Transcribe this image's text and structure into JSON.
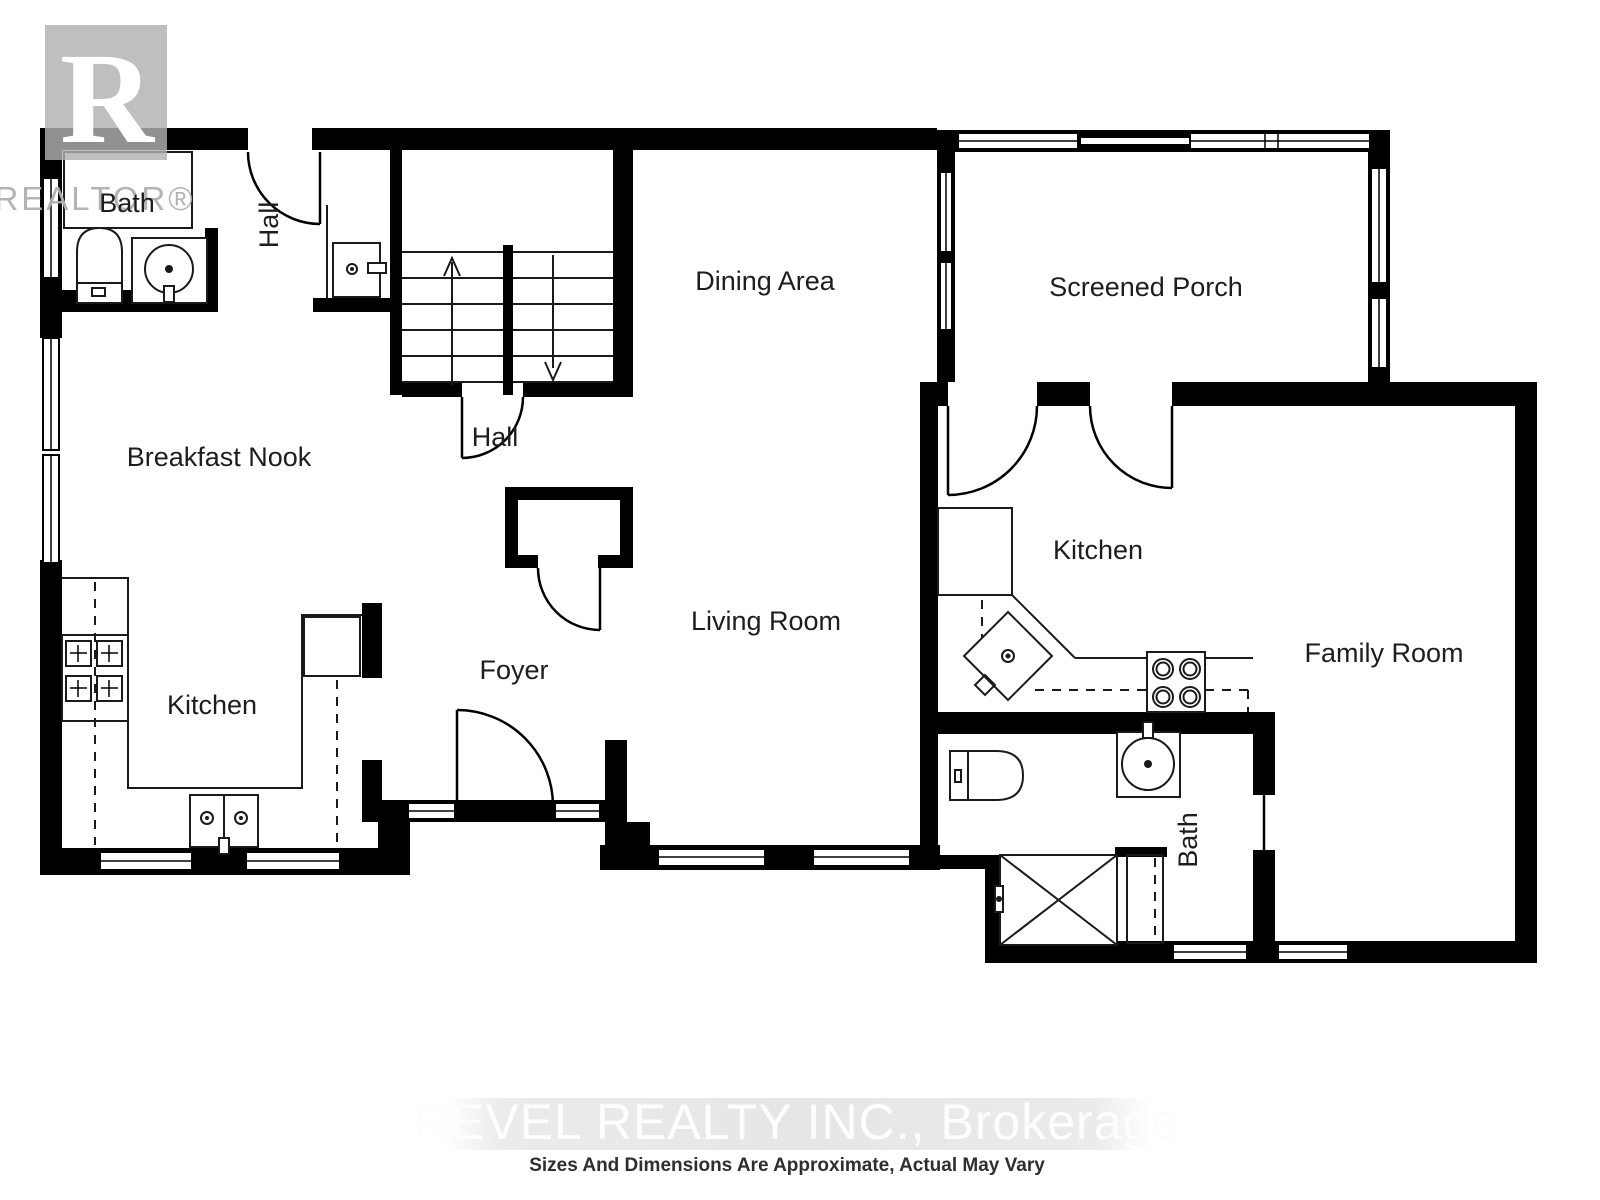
{
  "branding": {
    "logo_letter": "R",
    "logo_wordmark": "REALTOR®"
  },
  "rooms": {
    "bath_upper": "Bath",
    "hall_upper": "Hall",
    "breakfast_nook": "Breakfast Nook",
    "hall_lower": "Hall",
    "dining_area": "Dining Area",
    "screened_porch": "Screened Porch",
    "kitchen_right": "Kitchen",
    "kitchen_left": "Kitchen",
    "foyer": "Foyer",
    "living_room": "Living Room",
    "family_room": "Family Room",
    "bath_lower": "Bath"
  },
  "watermark": {
    "brokerage": "REVEL REALTY INC., Brokerage",
    "disclaimer": "Sizes And Dimensions Are Approximate, Actual May Vary"
  },
  "colors": {
    "wall": "#000000",
    "logo_gray": "#b1b1b1",
    "watermark_band": "#e7e7e7",
    "watermark_text": "#fdfdfd",
    "disclaimer_text": "#2e2e2e",
    "label_text": "#1d1d1d"
  }
}
